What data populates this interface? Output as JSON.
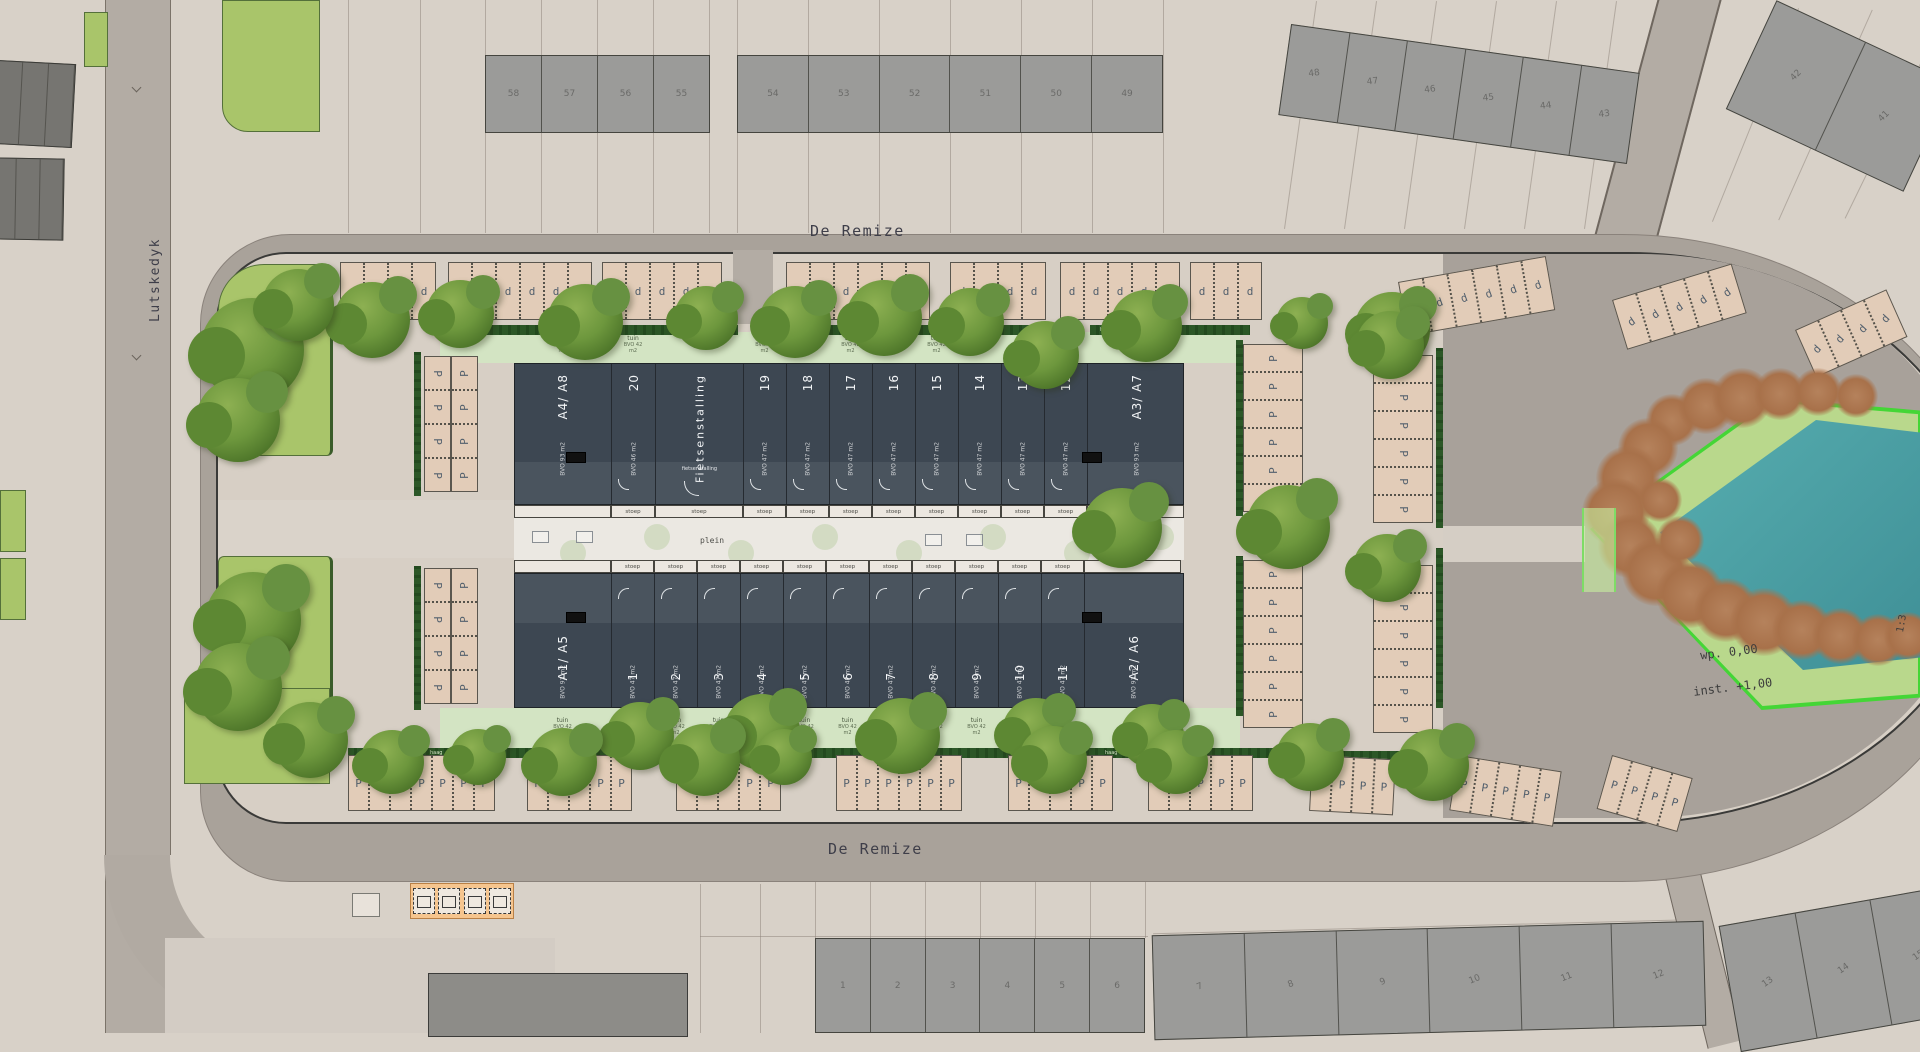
{
  "streets": {
    "top": "De Remize",
    "bottom": "De Remize",
    "left": "Lutskedyk"
  },
  "labels": {
    "plein": "plein",
    "stoep": "stoep",
    "tuin": "tuin",
    "tuin_area": "BVO 42 m2",
    "haag": "haag",
    "bike_storage": "Fietsenstalling",
    "bike_storage_small": "fietsenstalling",
    "parking_public": "P",
    "parking_private": "d"
  },
  "pond": {
    "water_level": "wp. 0,00",
    "inset_level": "inst. +1,00",
    "slope": "1:3"
  },
  "north_building": {
    "units": [
      {
        "label": "A4/ A8",
        "area": "BVO 93 m2",
        "kind": "corner"
      },
      {
        "label": "20",
        "area": "BVO 46 m2",
        "kind": "unit"
      },
      {
        "label": "Fietsenstalling",
        "area": "",
        "kind": "bike"
      },
      {
        "label": "19",
        "area": "BVO 47 m2",
        "kind": "unit"
      },
      {
        "label": "18",
        "area": "BVO 47 m2",
        "kind": "unit"
      },
      {
        "label": "17",
        "area": "BVO 47 m2",
        "kind": "unit"
      },
      {
        "label": "16",
        "area": "BVO 47 m2",
        "kind": "unit"
      },
      {
        "label": "15",
        "area": "BVO 47 m2",
        "kind": "unit"
      },
      {
        "label": "14",
        "area": "BVO 47 m2",
        "kind": "unit"
      },
      {
        "label": "13",
        "area": "BVO 47 m2",
        "kind": "unit"
      },
      {
        "label": "12",
        "area": "BVO 47 m2",
        "kind": "unit"
      },
      {
        "label": "A3/ A7",
        "area": "BVO 93 m2",
        "kind": "corner"
      }
    ]
  },
  "south_building": {
    "units": [
      {
        "label": "A1/ A5",
        "area": "BVO 93 m2",
        "kind": "corner"
      },
      {
        "label": "1",
        "area": "BVO 47 m2",
        "kind": "unit"
      },
      {
        "label": "2",
        "area": "BVO 47 m2",
        "kind": "unit"
      },
      {
        "label": "3",
        "area": "BVO 47 m2",
        "kind": "unit"
      },
      {
        "label": "4",
        "area": "BVO 47 m2",
        "kind": "unit"
      },
      {
        "label": "5",
        "area": "BVO 47 m2",
        "kind": "unit"
      },
      {
        "label": "6",
        "area": "BVO 47 m2",
        "kind": "unit"
      },
      {
        "label": "7",
        "area": "BVO 47 m2",
        "kind": "unit"
      },
      {
        "label": "8",
        "area": "BVO 47 m2",
        "kind": "unit"
      },
      {
        "label": "9",
        "area": "BVO 47 m2",
        "kind": "unit"
      },
      {
        "label": "10",
        "area": "BVO 47 m2",
        "kind": "unit"
      },
      {
        "label": "11",
        "area": "BVO 47 m2",
        "kind": "unit"
      },
      {
        "label": "A2/ A6",
        "area": "BVO 93 m2",
        "kind": "corner"
      }
    ]
  },
  "neighborhood": {
    "north_blocks": [
      {
        "numbers": [
          "58",
          "57",
          "56",
          "55"
        ]
      },
      {
        "numbers": [
          "54",
          "53",
          "52",
          "51",
          "50",
          "49"
        ]
      },
      {
        "numbers": [
          "48",
          "47",
          "46",
          "45",
          "44",
          "43"
        ]
      },
      {
        "numbers": [
          "42",
          "41"
        ]
      }
    ],
    "south_blocks": [
      {
        "numbers": [
          "1",
          "2",
          "3",
          "4",
          "5",
          "6"
        ]
      },
      {
        "numbers": [
          "7",
          "8",
          "9",
          "10",
          "11",
          "12"
        ]
      },
      {
        "numbers": [
          "13",
          "14",
          "15"
        ]
      }
    ]
  },
  "palette": {
    "building": "#3d4752",
    "water": "#4aa0a5",
    "greenspace": "#a9c56a",
    "hedge": "#2c5727",
    "stall": "#e2ccb8",
    "road": "#a9a29a",
    "island": "#b9d88c"
  }
}
